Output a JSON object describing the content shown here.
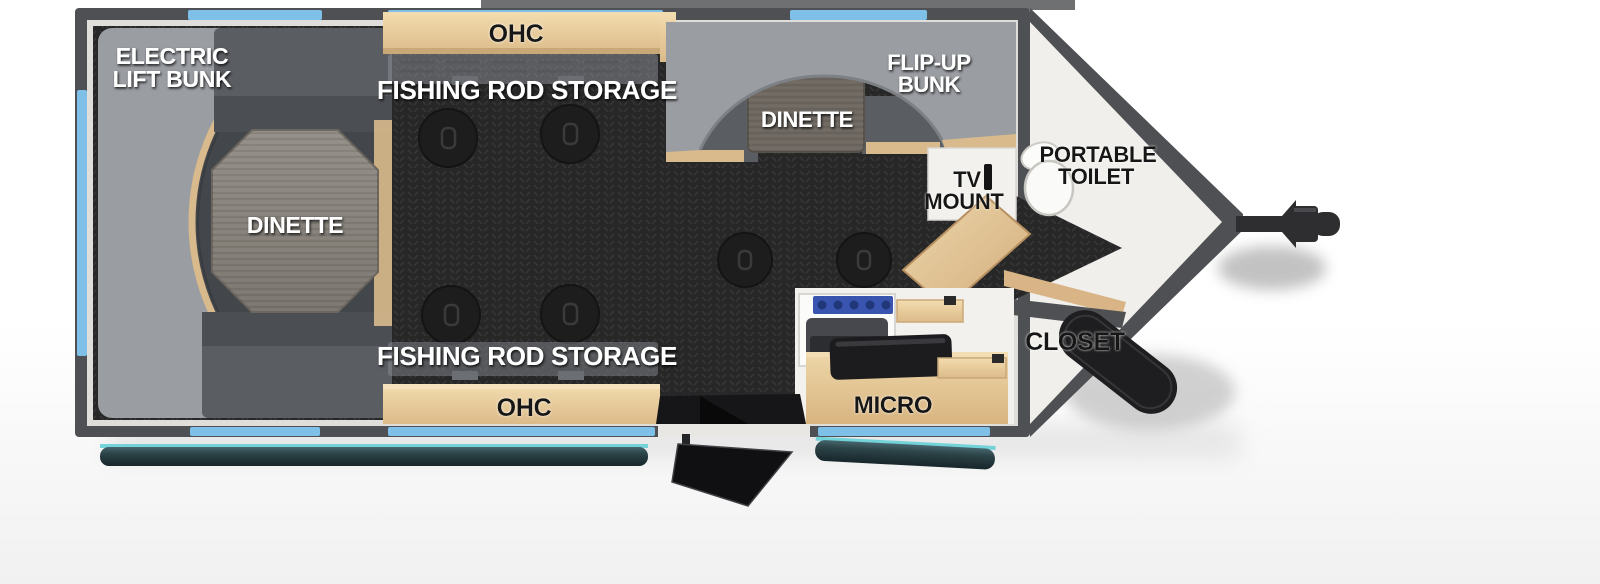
{
  "floorplan": {
    "type": "travel-trailer-fish-house-floorplan",
    "labels": {
      "electric_lift_bunk": {
        "line1": "ELECTRIC",
        "line2": "LIFT BUNK"
      },
      "ohc_top": "OHC",
      "fishing_rod_storage_top": "FISHING ROD STORAGE",
      "flip_up_bunk": {
        "line1": "FLIP-UP",
        "line2": "BUNK"
      },
      "dinette_left": "DINETTE",
      "dinette_right": "DINETTE",
      "tv_mount": {
        "line1": "TV",
        "line2": "MOUNT"
      },
      "portable_toilet": {
        "line1": "PORTABLE",
        "line2": "TOILET"
      },
      "closet": "CLOSET",
      "micro": "MICRO",
      "fishing_rod_storage_bottom": "FISHING ROD STORAGE",
      "ohc_bottom": "OHC"
    },
    "colors": {
      "wall": "#4e5054",
      "wall_cap": "#6e7072",
      "inner_trim": "#dfdedb",
      "window": "#7fc0e8",
      "floor": "#272727",
      "floor_texture": "#3b3b3b",
      "fishing_hole": "#1d1d1d",
      "bunk_gray": "#9a9da2",
      "bunk_shadow_circle": "#43464b",
      "bench_gray": "#5a5d62",
      "bench_dark": "#4b4e53",
      "table_wood_left": "#8a857e",
      "table_wood_right": "#6f6962",
      "cabinet_wood": "#e9cfa2",
      "wood_trim": "#d9b486",
      "white_floor": "#f0efeb",
      "white_wall": "#f2f1ed",
      "cooktop_blue": "#3a55b0",
      "appliance_dark": "#46484d",
      "black": "#19191b",
      "awning_tube": "#2c4347",
      "awning_highlight": "#5fced6",
      "label_white": "#ffffff",
      "label_black": "#161616"
    },
    "icons": [
      {
        "name": "fishing-hole-icon",
        "shape": "circle-with-rounded-slot",
        "count": 6
      },
      {
        "name": "tv-icon",
        "shape": "vertical-bar",
        "count": 1
      },
      {
        "name": "toilet-icon",
        "shape": "oval-seat-with-lid",
        "count": 1
      },
      {
        "name": "hitch-icon",
        "shape": "tongue-and-coupler",
        "count": 1
      },
      {
        "name": "propane-tank-icon",
        "shape": "rounded-black-slab",
        "count": 1
      },
      {
        "name": "entry-door-icon",
        "shape": "open-door-panel",
        "count": 1
      },
      {
        "name": "entry-mat-icon",
        "shape": "dark-floor-mat",
        "count": 1
      },
      {
        "name": "awning-tube-icon",
        "shape": "horizontal-tube",
        "count": 2
      },
      {
        "name": "window-strip",
        "shape": "blue-strip",
        "count": 7
      }
    ]
  }
}
